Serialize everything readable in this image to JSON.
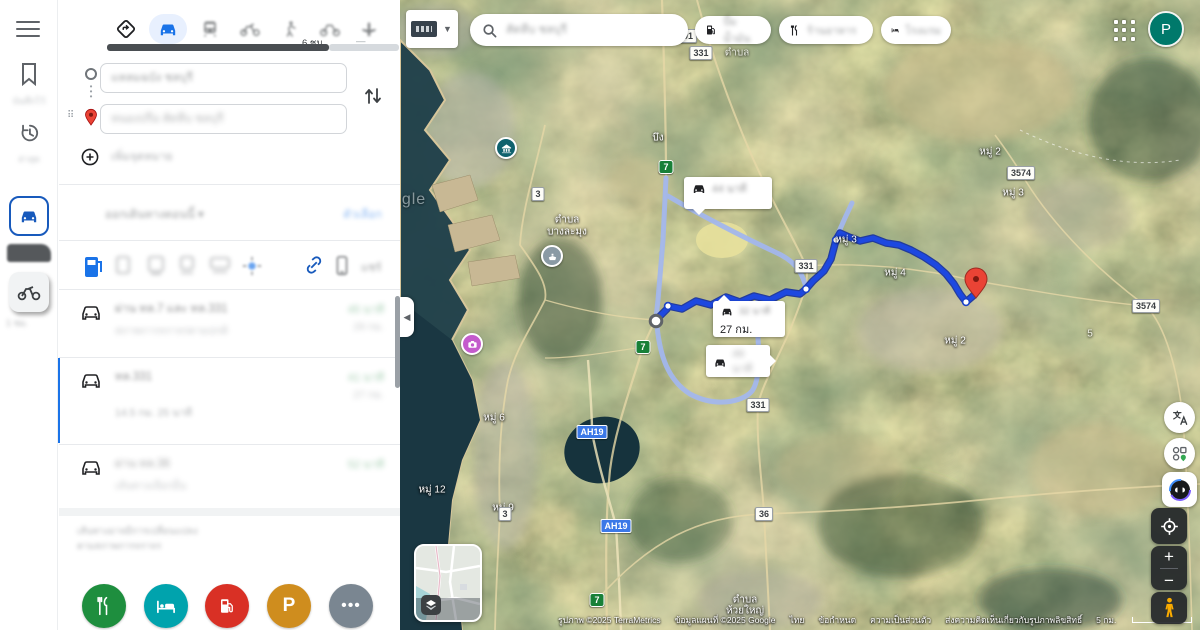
{
  "avatar": "P",
  "rail": {
    "saved_label": "บันทึกไว้",
    "recents_label": "ล่าสุด",
    "shortcut_caption": "1 ชม."
  },
  "panel": {
    "walk_time": "6 ชม.",
    "dash": "—",
    "origin_value": "แหลมฉบัง ชลบุรี",
    "destination_value": "หนองปรือ สัตหีบ ชลบุรี",
    "add_destination": "เพิ่มจุดหมาย",
    "leave_now": "ออกเดินทางตอนนี้ ▾",
    "options": "ตัวเลือก",
    "share_label": "แชร์",
    "routes": [
      {
        "title": "ผ่าน ทล.7 และ ทล.331",
        "subtitle": "สภาพการจราจรตามปกติ",
        "eta": "45 นาที",
        "dist": "29 กม."
      },
      {
        "title": "ทล.331",
        "subtitle": "",
        "eta": "41 นาที",
        "dist": "27 กม.",
        "chips": "14.5 กม.  25 นาที"
      },
      {
        "title": "ผ่าน ทล.36",
        "subtitle": "เส้นทางเลือกอื่น",
        "eta": "52 นาที"
      }
    ],
    "footnote1": "เส้นทางอาจมีการเปลี่ยนแปลง",
    "footnote2": "ตามสภาพการจราจร"
  },
  "topbar": {
    "search_value": "สัตหีบ ชลบุรี",
    "chips": [
      "ปั๊มน้ำมัน",
      "ร้านอาหาร",
      "โรงแรม"
    ]
  },
  "map": {
    "badges": [
      {
        "text": "3701"
      },
      {
        "text": "331"
      },
      {
        "text": "3"
      },
      {
        "text": "3574"
      },
      {
        "text": "331"
      },
      {
        "text": "3574"
      },
      {
        "text": "331"
      },
      {
        "text": "36"
      },
      {
        "text": "3"
      },
      {
        "text": "7"
      },
      {
        "text": "7"
      },
      {
        "text": "7"
      },
      {
        "text": "AH19"
      },
      {
        "text": "AH19"
      }
    ],
    "labels": [
      {
        "text": "บึง"
      },
      {
        "text": "ตำบล"
      },
      {
        "text": "ตำบล"
      },
      {
        "text": "บางละมุง"
      },
      {
        "text": "หมู่ 2"
      },
      {
        "text": "หมู่ 3"
      },
      {
        "text": "หมู่ 3"
      },
      {
        "text": "หมู่ 4"
      },
      {
        "text": "หมู่ 2"
      },
      {
        "text": "หมู่ 6"
      },
      {
        "text": "หมู่ 12"
      },
      {
        "text": "หมู่ 9"
      },
      {
        "text": "ตำบล"
      },
      {
        "text": "ห้วยใหญ่"
      },
      {
        "text": "5"
      },
      {
        "text": "gle"
      }
    ],
    "callouts": {
      "a_time": "44 นาที",
      "b_time": "32 นาที",
      "b_dist": "27 กม.",
      "c_time": "49 นาที"
    },
    "attribution": {
      "imagery": "รูปภาพ ©2025 TerraMetrics",
      "mapdata": "ข้อมูลแผนที่ ©2025 Google",
      "country": "ไทย",
      "terms": "ข้อกำหนด",
      "privacy": "ความเป็นส่วนตัว",
      "feedback": "ส่งความคิดเห็นเกี่ยวกับรูปภาพลิขสิทธิ์",
      "scale": "5 กม."
    }
  }
}
